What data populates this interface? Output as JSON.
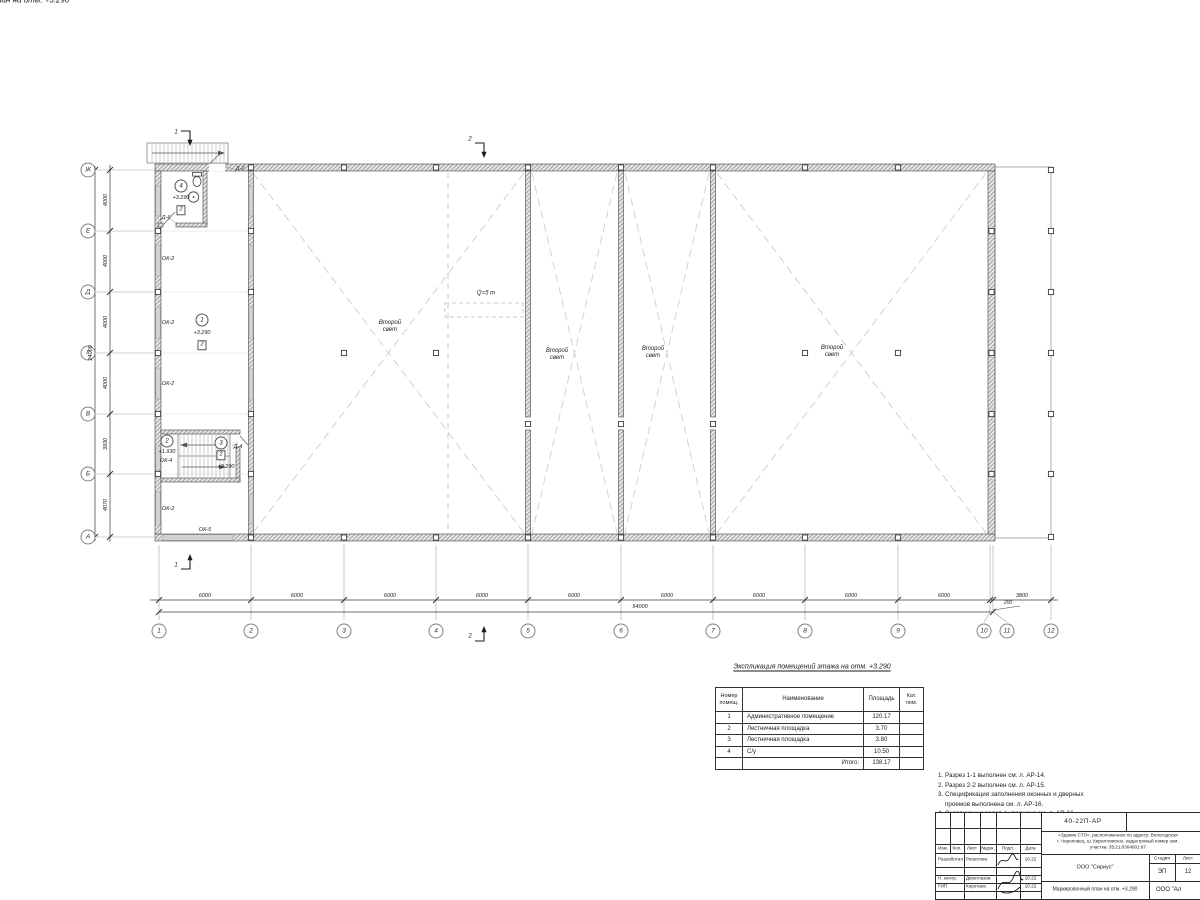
{
  "page_title": "Маркировочный план на отм. +3.290",
  "axes": {
    "cols": [
      "1",
      "2",
      "3",
      "4",
      "5",
      "6",
      "7",
      "8",
      "9",
      "10",
      "11",
      "12"
    ],
    "rows": [
      "Ж",
      "Е",
      "Д",
      "Г",
      "В",
      "Б",
      "А"
    ]
  },
  "dims": {
    "bay": "6000",
    "last_bay": "3800",
    "gap": "200",
    "total_width": "54000",
    "v_bays": [
      "4000",
      "4000",
      "4000",
      "4000",
      "3930",
      "4070"
    ],
    "total_height": "24000"
  },
  "sections": {
    "s1": "1",
    "s2": "2"
  },
  "openings": {
    "ok2": "ОК-2",
    "ok4": "ОК-4",
    "ok5": "ОК-5",
    "d2": "Д-2",
    "d4": "Д-4",
    "d6": "Д-6"
  },
  "rooms": {
    "r1": {
      "num": "1",
      "elev": "+3.290",
      "cat": "2"
    },
    "r2": {
      "num": "2",
      "elev": "+1.930"
    },
    "r3": {
      "num": "3",
      "elev": "+3.290",
      "cat": "2"
    },
    "r4": {
      "num": "4",
      "elev": "+3.290",
      "cat": "2"
    }
  },
  "plan_labels": {
    "second_light": "Второй свет",
    "crane": "Q=5 т"
  },
  "explication": {
    "title": "Экспликация помещений этажа на отм. +3.290",
    "headers": {
      "num": "Номер\nпомещ.",
      "name": "Наименование",
      "area": "Площадь",
      "cat": "Кат.\nпом."
    },
    "rows": [
      {
        "num": "1",
        "name": "Административное помещение",
        "area": "120.17"
      },
      {
        "num": "2",
        "name": "Лестничная площадка",
        "area": "3.70"
      },
      {
        "num": "3",
        "name": "Лестничная площадка",
        "area": "3.80"
      },
      {
        "num": "4",
        "name": "С/у",
        "area": "10.50"
      }
    ],
    "total_label": "Итого:",
    "total": "138.17"
  },
  "notes": [
    "1. Разрез 1-1 выполнен см. л. АР-14.",
    "2. Разрез 2-2 выполнен см. л. АР-15.",
    "3. Спецификация заполнения оконных и дверных",
    "    проемов выполнена см. л. АР-16.",
    "4. Экспликация полов выполнена см. л. АР-16."
  ],
  "titleblock": {
    "doc_number": "40-22П-АР",
    "address1": "«Здание СТО», расположенное по адресу: Вологодская",
    "address2": "г. Череповец, ш. Кирилловское, кадастровый номер зем.",
    "address3": "участка: 35:21:0304001:67",
    "cols": {
      "izm": "Изм.",
      "kol": "Кол.",
      "list": "Лист",
      "ndok": "№док.",
      "podp": "Подл.",
      "date": "Дата"
    },
    "sign_rows": [
      {
        "role": "Разработал",
        "name": "Решетова",
        "date": "10.22"
      },
      {
        "role": "Н. контр.",
        "name": "Двоеглазов",
        "date": "10.22"
      },
      {
        "role": "ГИП",
        "name": "Коротаев",
        "date": "10.22"
      }
    ],
    "org": "ООО \"Сириус\"",
    "stage_label": "Стадия",
    "sheet_label": "Лист",
    "stage": "ЭП",
    "sheet": "12",
    "drawing_title": "Маркировочный план на отм. +3.290",
    "org2": "ООО \"Ал"
  }
}
